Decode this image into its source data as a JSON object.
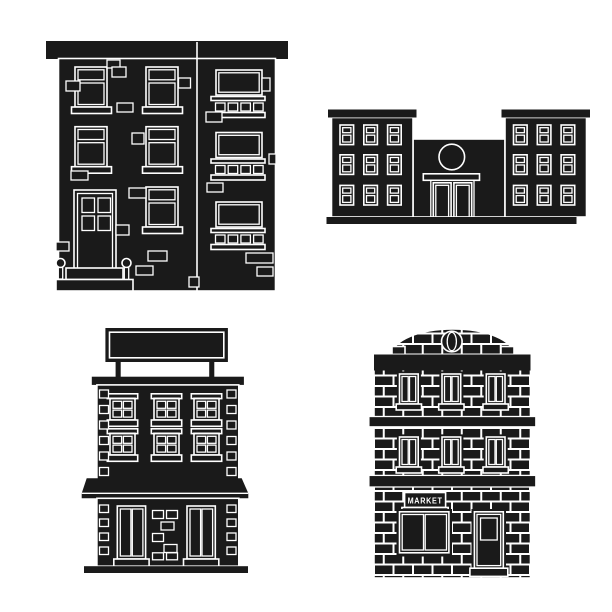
{
  "page": {
    "background": "#ffffff"
  },
  "colors": {
    "ink": "#1a1a1a",
    "paper": "#ffffff"
  },
  "icons": {
    "apartment": {
      "label": "apartment house with balconies icon"
    },
    "civic": {
      "label": "municipal building with two wings icon"
    },
    "shop": {
      "label": "store building with blank signboard icon"
    },
    "market": {
      "label": "brick market building icon",
      "sign_label": "MARKET"
    }
  }
}
